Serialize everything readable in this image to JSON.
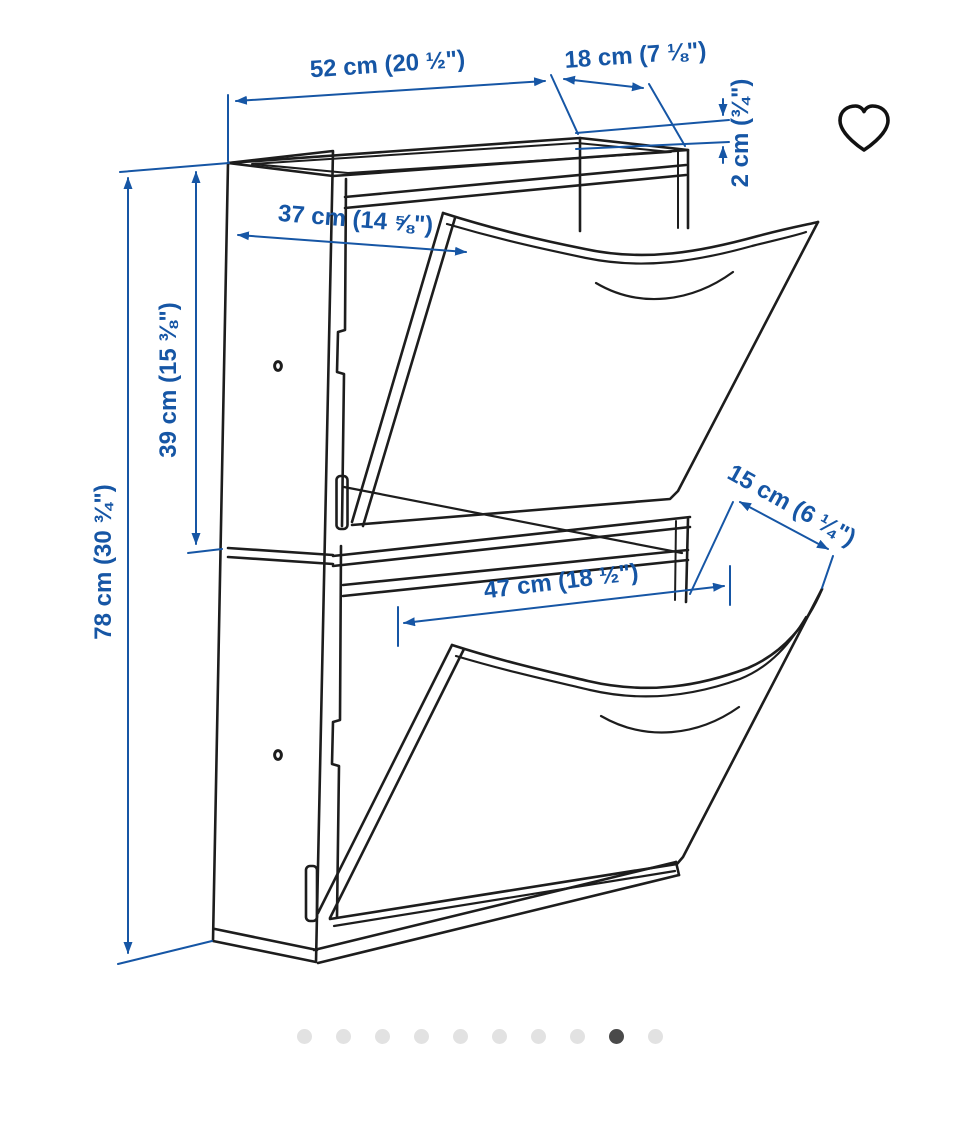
{
  "illustration": {
    "description_name": "shoe-cabinet-dimension-drawing",
    "units": 2,
    "dimensions": {
      "width_top": {
        "label": "52 cm (20 ½\")"
      },
      "depth_top": {
        "label": "18 cm (7 ⅛\")"
      },
      "top_rail_height": {
        "label": "2 cm (¾\")"
      },
      "open_flap_depth": {
        "label": "37 cm (14 ⅝\")"
      },
      "unit_height": {
        "label": "39 cm (15 ⅜\")"
      },
      "total_height": {
        "label": "78 cm (30 ¾\")"
      },
      "flap_width": {
        "label": "47 cm (18 ½\")"
      },
      "top_shelf_depth": {
        "label": "15 cm (6 ¼\")"
      }
    },
    "colors": {
      "dimension_blue": "#1656a5",
      "line_color": "#1d1d1d",
      "background": "#ffffff"
    }
  },
  "favorite": {
    "icon": "heart-outline",
    "color": "#111111"
  },
  "pagination": {
    "count": 10,
    "active_index": 8,
    "active_color": "#4a4a4a",
    "inactive_color": "#e2e2e2"
  }
}
